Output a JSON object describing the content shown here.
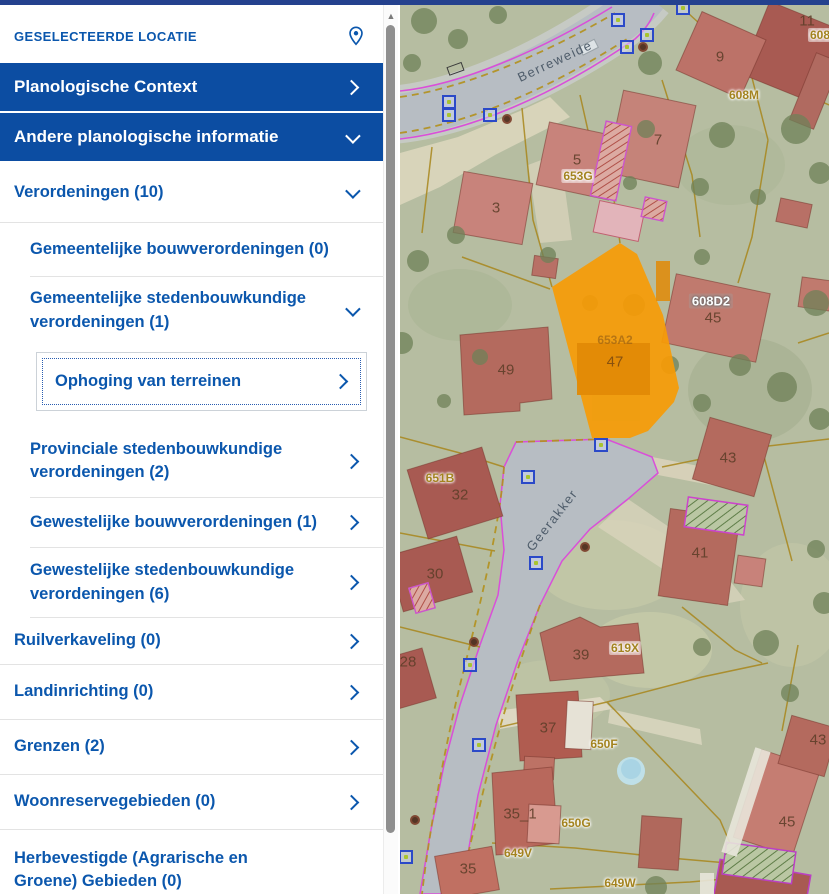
{
  "sidebar": {
    "title": "GESELECTEERDE LOCATIE",
    "accordions": [
      {
        "label": "Planologische Context",
        "chevron": "right"
      },
      {
        "label": "Andere planologische informatie",
        "chevron": "down"
      }
    ],
    "items": [
      {
        "label": "Verordeningen (10)",
        "chevron": "down"
      },
      {
        "label": "Gemeentelijke bouwverordeningen (0)",
        "chevron": "none"
      },
      {
        "label": "Gemeentelijke stedenbouwkundige verordeningen (1)",
        "chevron": "down"
      },
      {
        "label": "Ophoging van terreinen",
        "chevron": "right"
      },
      {
        "label": "Provinciale stedenbouwkundige verordeningen (2)",
        "chevron": "right"
      },
      {
        "label": "Gewestelijke bouwverordeningen (1)",
        "chevron": "right"
      },
      {
        "label": "Gewestelijke stedenbouwkundige verordeningen (6)",
        "chevron": "right"
      },
      {
        "label": "Ruilverkaveling (0)",
        "chevron": "right"
      },
      {
        "label": "Landinrichting (0)",
        "chevron": "right"
      },
      {
        "label": "Grenzen (2)",
        "chevron": "right"
      },
      {
        "label": "Woonreservegebieden (0)",
        "chevron": "right"
      },
      {
        "label": "Herbevestigde (Agrarische en Groene) Gebieden (0)",
        "chevron": "none"
      }
    ]
  },
  "map": {
    "streets": [
      {
        "text": "Berreweide"
      },
      {
        "text": "Geerakker"
      }
    ],
    "houses": [
      {
        "text": "11"
      },
      {
        "text": "9"
      },
      {
        "text": "7"
      },
      {
        "text": "5"
      },
      {
        "text": "3"
      },
      {
        "text": "49"
      },
      {
        "text": "45"
      },
      {
        "text": "47"
      },
      {
        "text": "43"
      },
      {
        "text": "32"
      },
      {
        "text": "41"
      },
      {
        "text": "30"
      },
      {
        "text": "39"
      },
      {
        "text": "28"
      },
      {
        "text": "37"
      },
      {
        "text": "35_1"
      },
      {
        "text": "35"
      },
      {
        "text": "45"
      },
      {
        "text": "43"
      }
    ],
    "parcels": [
      {
        "text": "608M"
      },
      {
        "text": "608"
      },
      {
        "text": "653G"
      },
      {
        "text": "608D2"
      },
      {
        "text": "653A2"
      },
      {
        "text": "651B"
      },
      {
        "text": "619X"
      },
      {
        "text": "650F"
      },
      {
        "text": "650G"
      },
      {
        "text": "649V"
      },
      {
        "text": "649W"
      }
    ],
    "selected_parcel": {
      "house_number": "47",
      "parcel_code": "653A2"
    }
  },
  "colors": {
    "accent_blue": "#0c4da2",
    "link_blue": "#0b57ad",
    "selection_orange": "#f79b05",
    "marker_blue": "#2b49c8",
    "parcel_line_olive": "#a8861b",
    "road_edge_magenta": "#d94fd9"
  }
}
